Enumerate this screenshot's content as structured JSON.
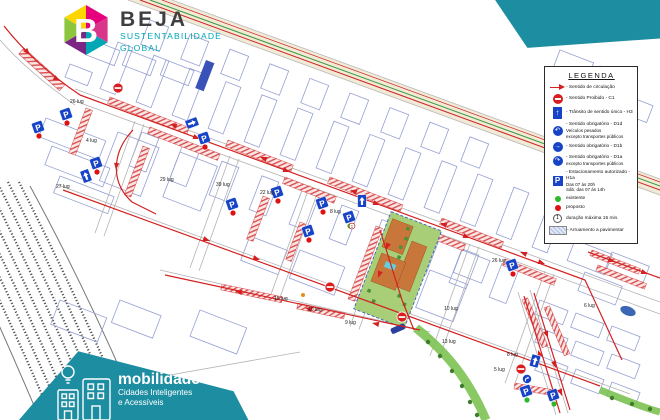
{
  "brand": {
    "name": "BEJA",
    "sub1": "SUSTENTABILIDADE",
    "sub2": "GLOBAL"
  },
  "banner": {
    "title": "mobilidade",
    "sub1": "Cidades Inteligentes",
    "sub2": "e Acessíveis"
  },
  "legend": {
    "title": "LEGENDA",
    "items": [
      {
        "label": "- Sentido de circulação"
      },
      {
        "label": "- Sentido Proibido - C1"
      },
      {
        "label": "- Trânsito de sentido único - H3"
      },
      {
        "label": "- Sentido obrigatório - D1d",
        "sub1": "Veículos pesados",
        "sub2": "excepto transportes públicos"
      },
      {
        "label": "- Sentido obrigatório - D1b"
      },
      {
        "label": "- Sentido obrigatório - D1a",
        "sub1": "excepto transportes públicos"
      },
      {
        "label": "- Estacionamento autorizado - H1a",
        "sub1": "Das 07 às 20h",
        "sub2": "Sáb. das 07 às 14h"
      },
      {
        "label": "existente"
      },
      {
        "label": "proposto"
      },
      {
        "label": "duração máxima 15 min."
      },
      {
        "label": "- Arruamento a pavimentar"
      }
    ]
  },
  "map": {
    "parking_labels": [
      {
        "t": "26 lug",
        "x": 70,
        "y": 103
      },
      {
        "t": "4 lug",
        "x": 86,
        "y": 142
      },
      {
        "t": "27 lug",
        "x": 56,
        "y": 188
      },
      {
        "t": "29 lug",
        "x": 160,
        "y": 181
      },
      {
        "t": "39 lug",
        "x": 216,
        "y": 186
      },
      {
        "t": "22 lug",
        "x": 260,
        "y": 194
      },
      {
        "t": "8 lug",
        "x": 330,
        "y": 213
      },
      {
        "t": "15 lug",
        "x": 274,
        "y": 300
      },
      {
        "t": "10 lug",
        "x": 308,
        "y": 311
      },
      {
        "t": "9 lug",
        "x": 345,
        "y": 324
      },
      {
        "t": "26 lug",
        "x": 492,
        "y": 262
      },
      {
        "t": "10 lug",
        "x": 444,
        "y": 310
      },
      {
        "t": "13 lug",
        "x": 442,
        "y": 343
      },
      {
        "t": "8 lug",
        "x": 507,
        "y": 356
      },
      {
        "t": "5 lug",
        "x": 494,
        "y": 371
      },
      {
        "t": "6 lug",
        "x": 584,
        "y": 307
      }
    ]
  },
  "colors": {
    "teal": "#1d8da1",
    "logo_teal": "#00a7b5",
    "red": "#d42020",
    "sign_blue": "#1743c7",
    "dot_green": "#2db82d",
    "dot_red": "#e01010"
  }
}
